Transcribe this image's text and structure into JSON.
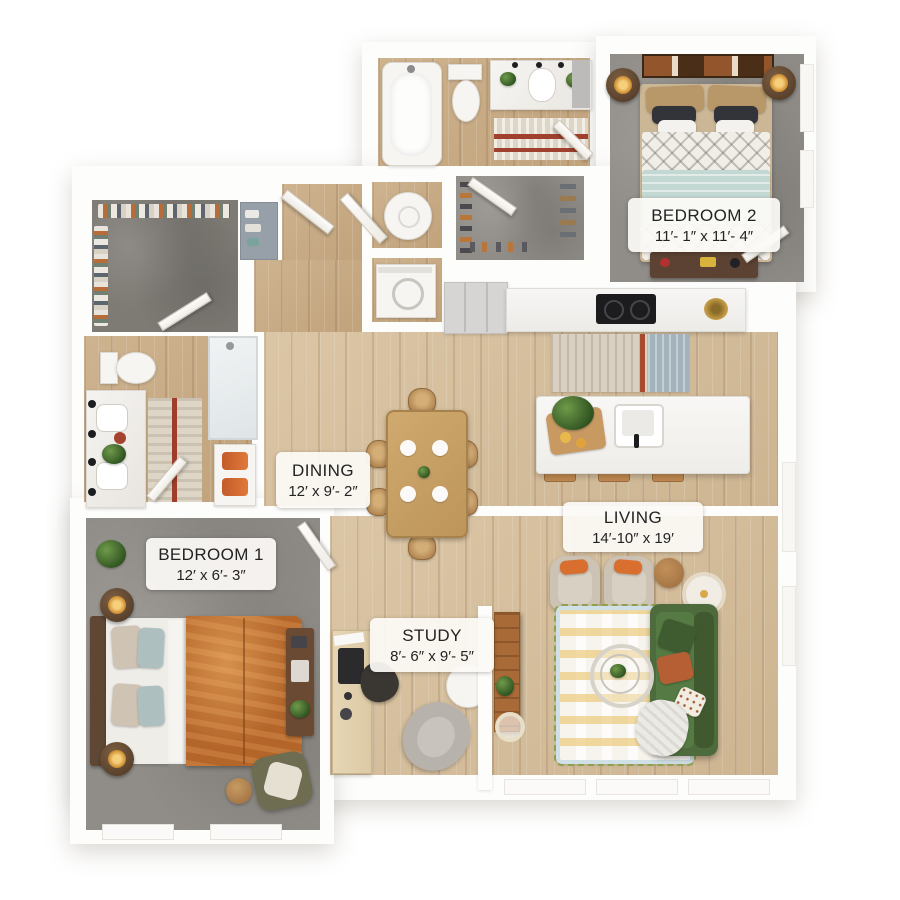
{
  "floorplan": {
    "rooms": [
      {
        "name": "BEDROOM 2",
        "dims": "11′- 1″ x 11′- 4″"
      },
      {
        "name": "DINING",
        "dims": "12′ x 9′- 2″"
      },
      {
        "name": "LIVING",
        "dims": "14′-10″ x 19′"
      },
      {
        "name": "BEDROOM 1",
        "dims": "12′ x 6′- 3″"
      },
      {
        "name": "STUDY",
        "dims": "8′- 6″ x 9′- 5″"
      }
    ],
    "colors": {
      "wood_floor": "#c9ab83",
      "wood_floor_light": "#d7bf9b",
      "carpet_gray": "#908d88",
      "sofa_green": "#4d6b3c",
      "duvet_orange": "#b4662a",
      "throw_teal": "#c3d8d3",
      "wall_white": "#fdfdfc"
    }
  }
}
